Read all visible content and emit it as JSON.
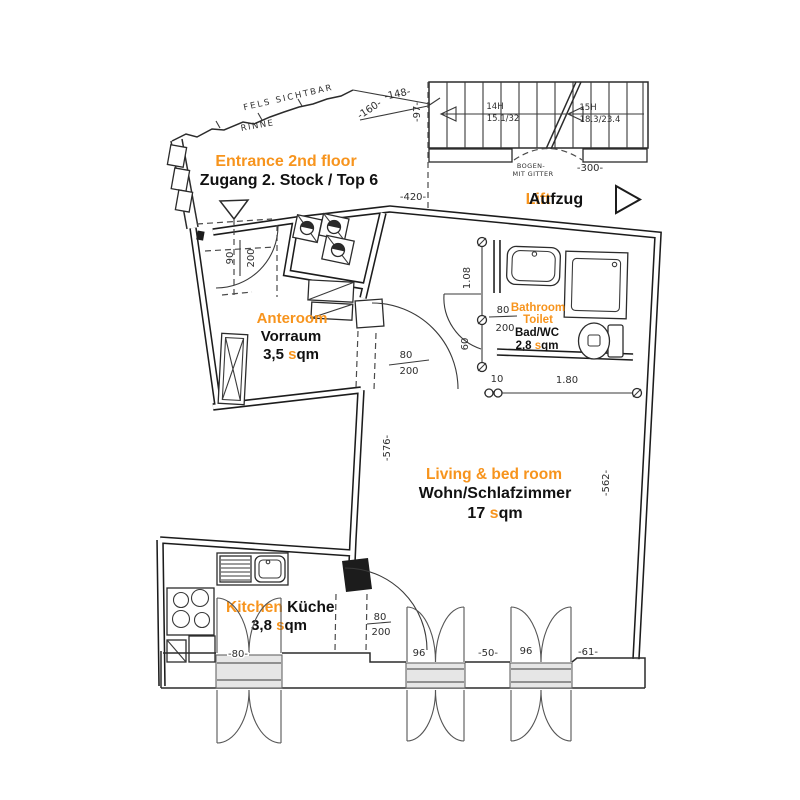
{
  "accent_color": "#f7941d",
  "rooms": {
    "entrance": {
      "name_en": "Entrance 2nd floor",
      "name_de": "Zugang 2. Stock / Top 6"
    },
    "lift": {
      "name_en": "Lift",
      "name_de": "Aufzug"
    },
    "anteroom": {
      "name_en": "Anteroom",
      "name_de": "Vorraum",
      "area": "3,5 ",
      "unit_accent": "s",
      "unit_tail": "qm"
    },
    "bathroom": {
      "name_en_line1": "Bathroom",
      "name_en_line2": "Toilet",
      "name_de": "Bad/WC",
      "area": "2,8 ",
      "unit_accent": "s",
      "unit_tail": "qm"
    },
    "living": {
      "name_en": "Living & bed room",
      "name_de": "Wohn/Schlafzimmer",
      "area": "17 ",
      "unit_accent": "s",
      "unit_tail": "qm"
    },
    "kitchen": {
      "name_en": "Kitchen ",
      "name_de": "Küche",
      "area": "3,8 ",
      "unit_accent": "s",
      "unit_tail": "qm"
    }
  },
  "site_annotations": {
    "rock": "FELS SICHTBAR",
    "gutter": "RINNE",
    "arch_line1": "BOGEN-",
    "arch_line2": "MIT GITTER"
  },
  "staircase": {
    "flight1_steps": "14H",
    "flight1_ratio": "15.1/32",
    "flight2_steps": "15H",
    "flight2_ratio": "18.3/23.4"
  },
  "dimensions": {
    "d148": "-148-",
    "d160": "-160-",
    "d97": "-97-",
    "d420": "-420-",
    "d300": "-300-",
    "entrance_door_w": "90",
    "entrance_door_h": "200",
    "living_door_w": "80",
    "living_door_h": "200",
    "bath_door_w": "80",
    "bath_door_h": "200",
    "kitchen_door_w": "80",
    "kitchen_door_h": "200",
    "bath_wall": "1.08",
    "bath_recess": "60",
    "bath_step": "10",
    "bath_width": "1.80",
    "living_height_left": "-576-",
    "living_height_right": "-562-",
    "kitchen_window": "-80-",
    "window_living_1": "96",
    "window_gap": "-50-",
    "window_living_2": "96",
    "corner": "-61-"
  }
}
